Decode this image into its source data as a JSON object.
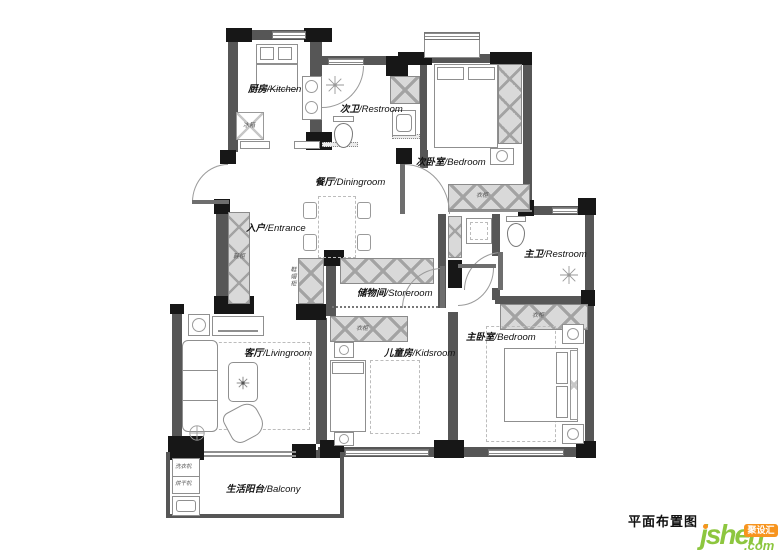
{
  "title": "平面布置图",
  "logo": {
    "name": "jsheh",
    "tld": ".com",
    "badge": "聚设汇"
  },
  "rooms": {
    "kitchen": {
      "cn": "厨房",
      "en": "/Kitchen"
    },
    "bath2": {
      "cn": "次卫",
      "en": "/Restroom"
    },
    "bedroom2": {
      "cn": "次卧室",
      "en": "/Bedroom"
    },
    "dining": {
      "cn": "餐厅",
      "en": "/Diningroom"
    },
    "entrance": {
      "cn": "入户",
      "en": "/Entrance"
    },
    "storeroom": {
      "cn": "储物间",
      "en": "/Storeroom"
    },
    "bath1": {
      "cn": "主卫",
      "en": "/Restroom"
    },
    "living": {
      "cn": "客厅",
      "en": "/Livingroom"
    },
    "kids": {
      "cn": "儿童房",
      "en": "/Kidsroom"
    },
    "bedroom1": {
      "cn": "主卧室",
      "en": "/Bedroom"
    },
    "balcony": {
      "cn": "生活阳台",
      "en": "/Balcony"
    }
  },
  "furniture": {
    "fridge": "冰箱",
    "wardrobe": "衣柜",
    "shoe_cabinet": "鞋柜",
    "hall_cabinet": "鞋帽柜",
    "washer": "洗衣机",
    "dryer": "烘干机"
  },
  "colors": {
    "wall": "#565656",
    "wall_dark": "#171717",
    "hatch_fill": "#d9d9d9",
    "logo_green": "#8dc63f",
    "logo_orange": "#f7941e"
  }
}
